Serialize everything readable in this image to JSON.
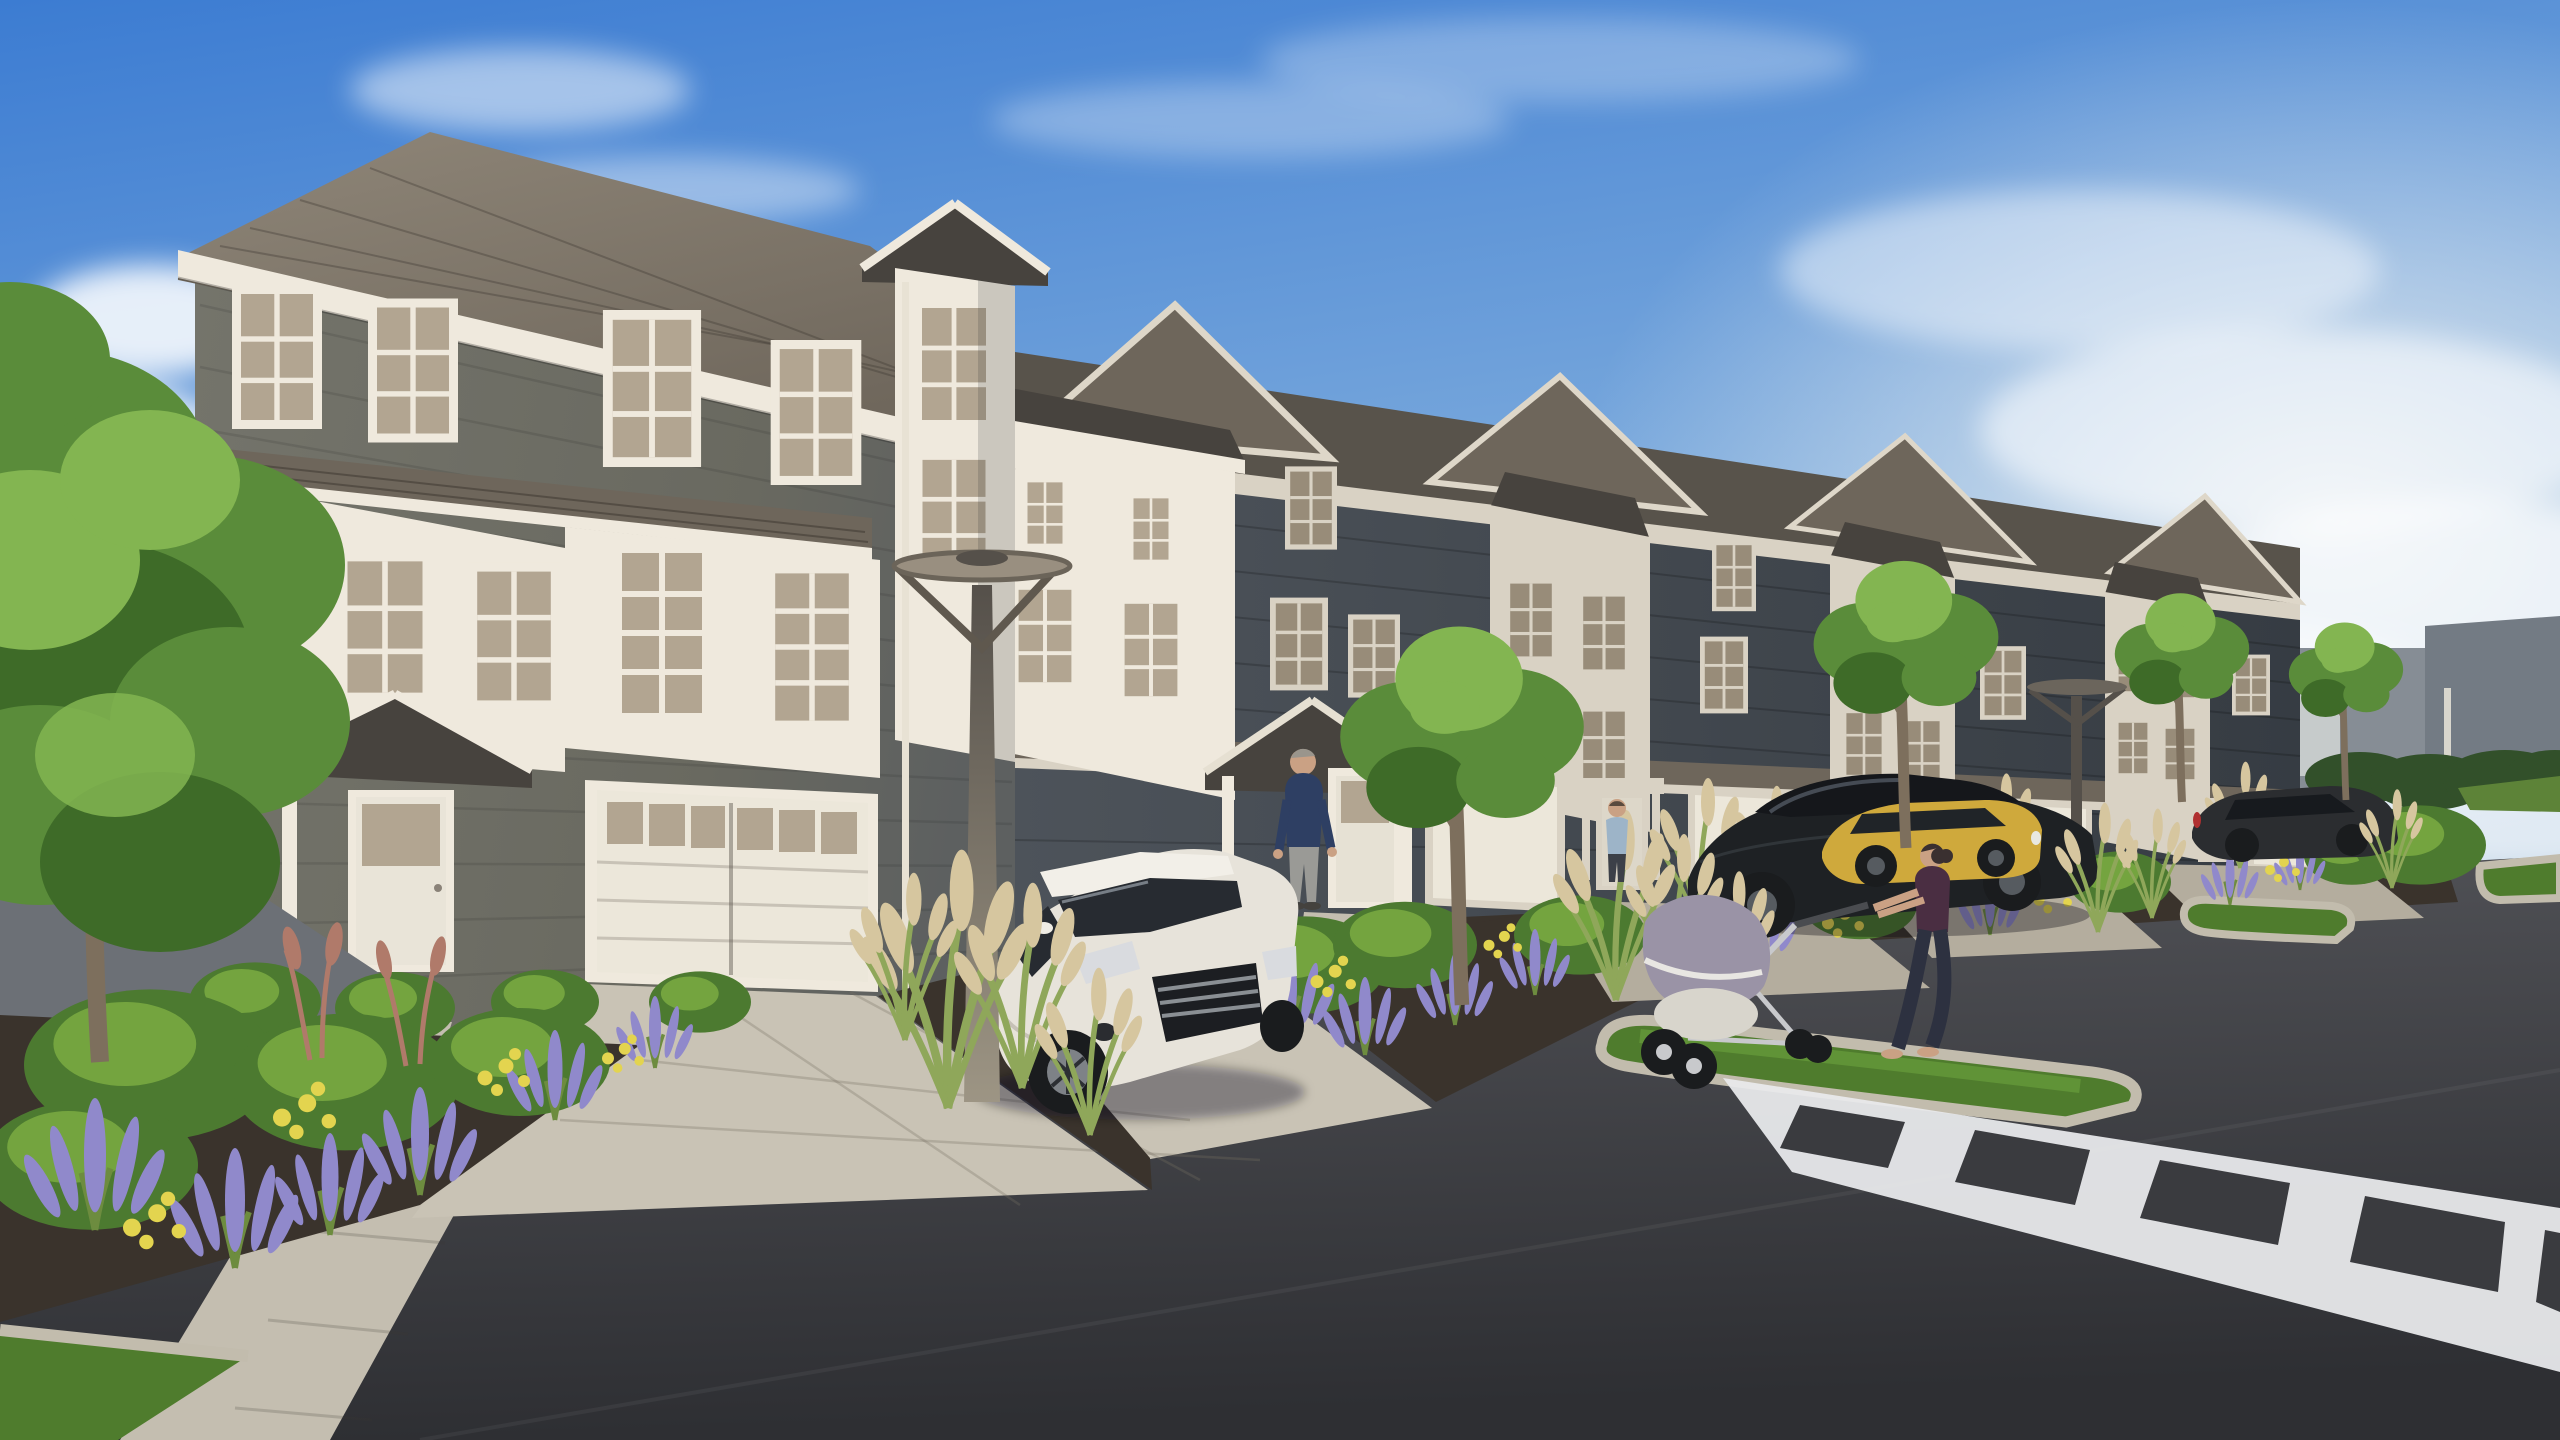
{
  "scene": {
    "type": "architectural-exterior-rendering",
    "subject": "three-story townhome row along a private street",
    "view": "street-level three-quarter perspective, row receding to the right",
    "sky": "blue with wispy white clouds, bright haze on the right",
    "lighting": "daytime sun from the left"
  },
  "palette": {
    "sky_top": "#3c7cd2",
    "sky_mid": "#85b1de",
    "sky_low": "#c2d2e0",
    "cloud": "#ffffff",
    "siding_lit": "#6f6f66",
    "siding_dark": "#454b52",
    "siding_deep": "#343a41",
    "trim_white": "#efe9dd",
    "trim_shade": "#d9d2c4",
    "roof_lit": "#857c6f",
    "roof_mid": "#6e665b",
    "roof_shadow": "#58534b",
    "roof_dark": "#47433e",
    "glass": "#b2a591",
    "glass_dark": "#988c79",
    "garage_white": "#ece7da",
    "asphalt_light": "#54555a",
    "asphalt_dark": "#2e2f33",
    "road_left": "#6c7076",
    "paver": "#c9c3b5",
    "paver_shade": "#b4ad9e",
    "sidewalk": "#c4beb0",
    "curb": "#c2bcad",
    "mulch": "#3a332c",
    "grass_green": "#4f7c2d",
    "grass_light": "#6da33e",
    "shrub": "#4c7a30",
    "shrub_light": "#74a43f",
    "lavender": "#9089cb",
    "yellow_flower": "#e3d44f",
    "plume": "#d6c69f",
    "blade": "#8fa75a",
    "red_grass": "#b07a6a",
    "tree_mid": "#5a8c3a",
    "tree_light": "#83b551",
    "tree_dark": "#3e6b28",
    "trunk": "#7d6f5d",
    "wall_far": "#868d95",
    "wall_far_dark": "#737b84",
    "wall_light": "#c6cbcb",
    "hedge": "#32502a",
    "field": "#5d8338",
    "crosswalk": "#e9eaec",
    "car_white": "#e7e3da",
    "car_black": "#1e2124",
    "car_yellow": "#cfa93c",
    "car_dark": "#2b2d30",
    "wheel": "#1a1c1e",
    "window_car": "#272b31",
    "lamp_pole_light": "#9d9584",
    "lamp_pole_dark": "#55504a",
    "skin": "#caa184",
    "navy_sweater": "#2e3f63",
    "grey_pants": "#9a9a96",
    "plum_top": "#4a2e42",
    "leggings": "#2d3140",
    "blue_shirt": "#9db4c8",
    "stroller_grey": "#9a93a6",
    "stroller_frame": "#c8c9cc",
    "hair_grey": "#9a958c",
    "hair_dark": "#3a3030"
  },
  "objects": {
    "buildings": {
      "townhome_units_visible": 7,
      "stories": 3,
      "materials": [
        "charcoal lap siding",
        "white panel bays",
        "white trim",
        "asphalt shingle roofs"
      ],
      "features": [
        "white double garage door",
        "gabled entry porches",
        "six-pane windows",
        "bay windows with pent shingle roofs"
      ]
    },
    "vehicles": [
      {
        "kind": "white hatchback",
        "position": "parked on front driveway, facing viewer"
      },
      {
        "kind": "black sedan",
        "position": "parked at middle driveway, side view"
      },
      {
        "kind": "yellow sedan",
        "position": "parked beyond black sedan"
      },
      {
        "kind": "dark hatchback",
        "position": "parked far right"
      }
    ],
    "people": [
      {
        "kind": "man, navy sweater, grey pants",
        "position": "standing at entry porch"
      },
      {
        "kind": "man, light blue shirt",
        "position": "standing at far entry door"
      },
      {
        "kind": "woman, dark top, leggings",
        "position": "pushing stroller along street"
      }
    ],
    "street_furniture": [
      {
        "kind": "modern disc lamppost",
        "position": "foreground planting bed"
      },
      {
        "kind": "modern disc lamppost",
        "position": "distant planting strip"
      }
    ],
    "landscaping": [
      "ornamental grasses with plumes",
      "lavender salvia",
      "yellow flowers",
      "round shrubs",
      "street trees",
      "mulch beds",
      "grass median islands"
    ],
    "road": {
      "surface": "dark asphalt",
      "markings": "white ladder crosswalk, bottom right",
      "islands": 3,
      "driveway_paving": "light grey pavers"
    }
  }
}
